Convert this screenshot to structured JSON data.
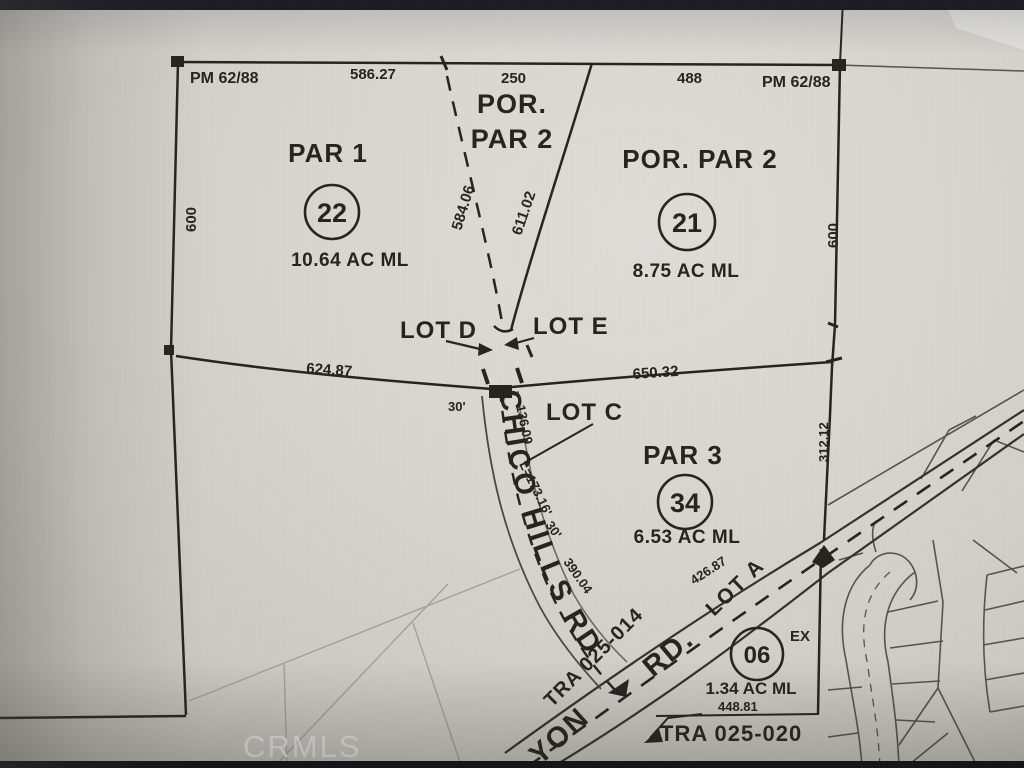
{
  "colors": {
    "paper": "#d6d5cf",
    "ink": "#26241f",
    "line_soft": "#4a4842",
    "faint": "#a3a19a",
    "bezel": "#15151c",
    "watermark": "#e8e8e5"
  },
  "watermark": "CRMLS",
  "map": {
    "refs": {
      "pm_left": "PM 62/88",
      "pm_right": "PM 62/88"
    },
    "dims": {
      "top_1": "586.27",
      "top_2": "250",
      "top_3": "488",
      "edge_left": "600",
      "edge_right": "600",
      "edge_right_lower": "312.12",
      "dashed": "584.06",
      "solid": "611.02",
      "mid_left": "624.87",
      "mid_right": "650.32",
      "corner_30": "30'",
      "road_136": "136.09",
      "road_arc": "L=173.16'",
      "road_30": "30'",
      "road_390": "390.04",
      "canyon_426": "426.87",
      "p06_448": "448.81"
    },
    "parcels": {
      "por_top": {
        "line1": "POR.",
        "line2": "PAR 2"
      },
      "par1": {
        "label": "PAR 1",
        "number": "22",
        "area": "10.64 AC ML"
      },
      "par2": {
        "label": "POR. PAR 2",
        "number": "21",
        "area": "8.75 AC ML"
      },
      "par3": {
        "label": "PAR 3",
        "number": "34",
        "area": "6.53 AC ML"
      },
      "p06": {
        "number": "06",
        "ex": "EX",
        "area": "1.34 AC ML"
      }
    },
    "lots": {
      "d": "LOT D",
      "e": "LOT E",
      "c": "LOT C",
      "a": "LOT A"
    },
    "roads": {
      "chico": "CHICO HILLS RD",
      "canyon_part": "YON",
      "canyon_rd": "RD."
    },
    "tra": {
      "t014": "TRA 025-014",
      "t020": "TRA 025-020"
    }
  }
}
